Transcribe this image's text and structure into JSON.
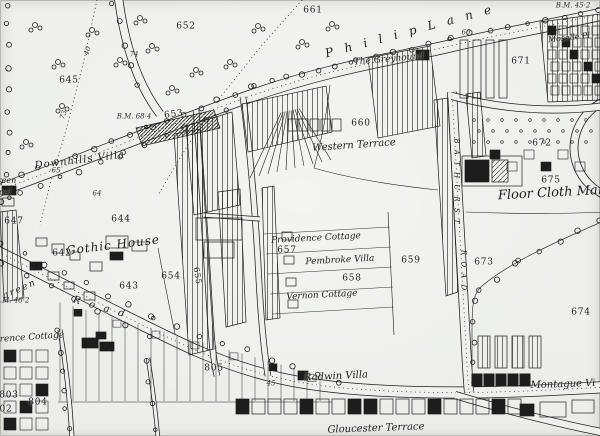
{
  "map": {
    "paper_color": "#eff0ec",
    "ink_color": "#1d1d1d",
    "labels": [
      {
        "n": "road-philip-lane",
        "t": "P h i l i p   L a n e",
        "x": 410,
        "y": 31,
        "s": 12,
        "r": -15,
        "c": "road",
        "sp": 4
      },
      {
        "n": "pub-the-greyhound",
        "t": "The Greyhound",
        "x": 389,
        "y": 60,
        "s": 9,
        "r": -5,
        "c": "it",
        "sp": 0
      },
      {
        "n": "western-terrace",
        "t": "Western Terrace",
        "x": 354,
        "y": 146,
        "s": 10,
        "r": -4,
        "c": "it",
        "sp": 0
      },
      {
        "n": "downhills-villa",
        "t": "Downhills Villa",
        "x": 80,
        "y": 161,
        "s": 10,
        "r": -7,
        "c": "it",
        "sp": 1
      },
      {
        "n": "gothic-house",
        "t": "Gothic House",
        "x": 113,
        "y": 245,
        "s": 12,
        "r": -7,
        "c": "it",
        "sp": 1
      },
      {
        "n": "providence-cottage",
        "t": "Providence Cottage",
        "x": 316,
        "y": 239,
        "s": 9,
        "r": -3,
        "c": "it",
        "sp": 0
      },
      {
        "n": "parcel-657",
        "t": "657",
        "x": 287,
        "y": 251,
        "s": 9,
        "r": 0,
        "c": "num",
        "sp": 0
      },
      {
        "n": "pembroke-villa",
        "t": "Pembroke Villa",
        "x": 340,
        "y": 261,
        "s": 9,
        "r": -3,
        "c": "it",
        "sp": 0
      },
      {
        "n": "parcel-658",
        "t": "658",
        "x": 352,
        "y": 279,
        "s": 9,
        "r": 0,
        "c": "num",
        "sp": 0
      },
      {
        "n": "vernon-cottage",
        "t": "Vernon Cottage",
        "x": 322,
        "y": 296,
        "s": 9,
        "r": -3,
        "c": "it",
        "sp": 0
      },
      {
        "n": "parcel-659",
        "t": "659",
        "x": 411,
        "y": 261,
        "s": 9,
        "r": 0,
        "c": "num",
        "sp": 0
      },
      {
        "n": "radwin-villa",
        "t": "Radwin Villa",
        "x": 336,
        "y": 377,
        "s": 10,
        "r": -3,
        "c": "it",
        "sp": 0
      },
      {
        "n": "montague-villas",
        "t": "Montague Vi",
        "x": 563,
        "y": 385,
        "s": 10,
        "r": -2,
        "c": "it",
        "sp": 0
      },
      {
        "n": "gloucester-terrace",
        "t": "Gloucester Terrace",
        "x": 376,
        "y": 429,
        "s": 10,
        "r": -2,
        "c": "it",
        "sp": 0
      },
      {
        "n": "moselle-place",
        "t": "Moselle Pl",
        "x": 569,
        "y": 38,
        "s": 8,
        "r": -6,
        "c": "it",
        "sp": 0
      },
      {
        "n": "floor-cloth-manufactory",
        "t": "Floor Cloth Man",
        "x": 552,
        "y": 193,
        "s": 13,
        "r": -3,
        "c": "it",
        "sp": 0
      },
      {
        "n": "cottage-name-fragment",
        "t": "rence Cottage",
        "x": 32,
        "y": 338,
        "s": 9,
        "r": -4,
        "c": "it",
        "sp": 0
      },
      {
        "n": "green-fragment",
        "t": "reen",
        "x": 7,
        "y": 181,
        "s": 8,
        "r": 0,
        "c": "it",
        "sp": 0
      },
      {
        "n": "chapel-fragment",
        "t": "pel",
        "x": 5,
        "y": 193,
        "s": 8,
        "r": 0,
        "c": "it",
        "sp": 0
      },
      {
        "n": "west-green-label",
        "t": "green",
        "x": 20,
        "y": 290,
        "s": 9,
        "r": -24,
        "c": "road",
        "sp": 2
      },
      {
        "n": "road-west-green",
        "t": "R o a d",
        "x": 100,
        "y": 308,
        "s": 10,
        "r": 16,
        "c": "road",
        "sp": 3
      },
      {
        "n": "road-bathurst-upper",
        "t": "B A T H U R S T",
        "x": 456,
        "y": 182,
        "s": 7,
        "r": 90,
        "c": "road",
        "sp": 2
      },
      {
        "n": "road-bathurst-lower",
        "t": "R O A D",
        "x": 463,
        "y": 271,
        "s": 7,
        "r": 90,
        "c": "road",
        "sp": 2
      },
      {
        "n": "parcel-661",
        "t": "661",
        "x": 313,
        "y": 11,
        "s": 9,
        "r": 0,
        "c": "num",
        "sp": 0
      },
      {
        "n": "parcel-652",
        "t": "652",
        "x": 186,
        "y": 27,
        "s": 9,
        "r": 0,
        "c": "num",
        "sp": 0
      },
      {
        "n": "parcel-645",
        "t": "645",
        "x": 69,
        "y": 81,
        "s": 9,
        "r": 0,
        "c": "num",
        "sp": 0
      },
      {
        "n": "parcel-653",
        "t": "653",
        "x": 174,
        "y": 115,
        "s": 9,
        "r": -8,
        "c": "num",
        "sp": 0
      },
      {
        "n": "parcel-647",
        "t": "647",
        "x": 14,
        "y": 222,
        "s": 9,
        "r": 0,
        "c": "num",
        "sp": 0
      },
      {
        "n": "parcel-644",
        "t": "644",
        "x": 121,
        "y": 220,
        "s": 9,
        "r": 0,
        "c": "num",
        "sp": 0
      },
      {
        "n": "parcel-642",
        "t": "642",
        "x": 62,
        "y": 254,
        "s": 9,
        "r": 0,
        "c": "num",
        "sp": 0
      },
      {
        "n": "parcel-643",
        "t": "643",
        "x": 129,
        "y": 287,
        "s": 9,
        "r": 0,
        "c": "num",
        "sp": 0
      },
      {
        "n": "parcel-654",
        "t": "654",
        "x": 171,
        "y": 277,
        "s": 9,
        "r": 0,
        "c": "num",
        "sp": 0
      },
      {
        "n": "parcel-655",
        "t": "655",
        "x": 197,
        "y": 276,
        "s": 8,
        "r": 80,
        "c": "num",
        "sp": 0
      },
      {
        "n": "parcel-660",
        "t": "660",
        "x": 361,
        "y": 124,
        "s": 9,
        "r": 0,
        "c": "num",
        "sp": 0
      },
      {
        "n": "parcel-671",
        "t": "671",
        "x": 521,
        "y": 62,
        "s": 9,
        "r": 0,
        "c": "num",
        "sp": 0
      },
      {
        "n": "parcel-672",
        "t": "672",
        "x": 542,
        "y": 144,
        "s": 9,
        "r": 0,
        "c": "num",
        "sp": 0
      },
      {
        "n": "parcel-673",
        "t": "673",
        "x": 484,
        "y": 263,
        "s": 9,
        "r": 0,
        "c": "num",
        "sp": 0
      },
      {
        "n": "parcel-674",
        "t": "674",
        "x": 581,
        "y": 313,
        "s": 9,
        "r": 0,
        "c": "num",
        "sp": 0
      },
      {
        "n": "parcel-675",
        "t": "675",
        "x": 551,
        "y": 181,
        "s": 9,
        "r": 0,
        "c": "num",
        "sp": 0
      },
      {
        "n": "parcel-803",
        "t": "803",
        "x": 9,
        "y": 396,
        "s": 9,
        "r": 0,
        "c": "num",
        "sp": 0
      },
      {
        "n": "parcel-804",
        "t": "804",
        "x": 38,
        "y": 403,
        "s": 9,
        "r": 0,
        "c": "num",
        "sp": 0
      },
      {
        "n": "parcel-802-fragment",
        "t": "02",
        "x": 6,
        "y": 410,
        "s": 9,
        "r": 0,
        "c": "num",
        "sp": 0
      },
      {
        "n": "parcel-805",
        "t": "805",
        "x": 214,
        "y": 369,
        "s": 9,
        "r": 0,
        "c": "num",
        "sp": 0
      },
      {
        "n": "benchmark-68-4",
        "t": "B.M. 68·4",
        "x": 134,
        "y": 117,
        "s": 7,
        "r": 0,
        "c": "bm",
        "sp": 0
      },
      {
        "n": "benchmark-45-2",
        "t": "B.M. 45·2",
        "x": 573,
        "y": 6,
        "s": 7,
        "r": 0,
        "c": "bm",
        "sp": 0
      },
      {
        "n": "benchmark-46-2",
        "t": "B.M. 46·2",
        "x": 12,
        "y": 301,
        "s": 7,
        "r": 0,
        "c": "bm",
        "sp": 0
      },
      {
        "n": "contour-40",
        "t": "40",
        "x": 88,
        "y": 51,
        "s": 7,
        "r": -70,
        "c": "tiny",
        "sp": 0
      },
      {
        "n": "contour-73",
        "t": "73",
        "x": 64,
        "y": 115,
        "s": 7,
        "r": -70,
        "c": "tiny",
        "sp": 0
      },
      {
        "n": "contour-74",
        "t": "74",
        "x": 134,
        "y": 55,
        "s": 7,
        "r": 0,
        "c": "tiny",
        "sp": 0
      },
      {
        "n": "contour-65",
        "t": "·65",
        "x": 55,
        "y": 171,
        "s": 7,
        "r": 0,
        "c": "tiny",
        "sp": 0
      },
      {
        "n": "contour-64",
        "t": "64",
        "x": 97,
        "y": 194,
        "s": 7,
        "r": 0,
        "c": "tiny",
        "sp": 0
      },
      {
        "n": "distance-60",
        "t": "60",
        "x": 466,
        "y": 33,
        "s": 7,
        "r": 0,
        "c": "tiny",
        "sp": 0
      },
      {
        "n": "distance-45",
        "t": "45",
        "x": 271,
        "y": 384,
        "s": 7,
        "r": 0,
        "c": "tiny",
        "sp": 0
      }
    ]
  }
}
